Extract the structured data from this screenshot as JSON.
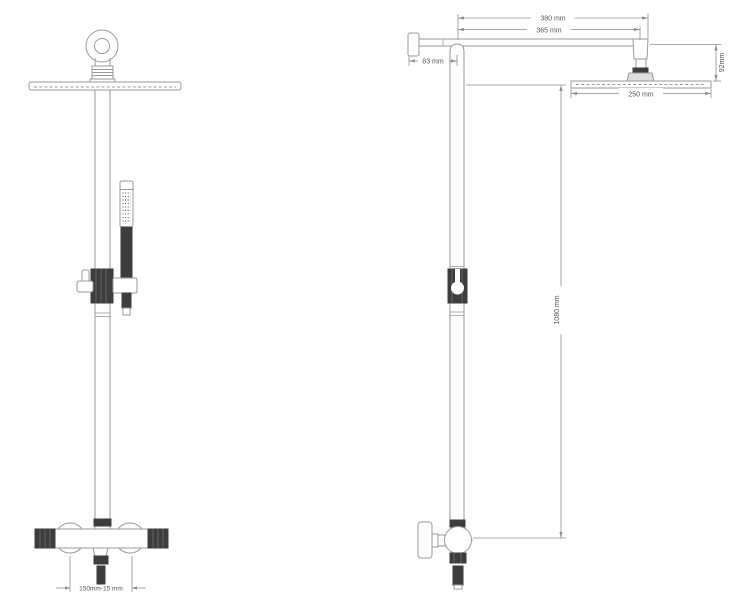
{
  "diagram": {
    "type": "technical-drawing",
    "subject": "thermostatic shower column, front view and side view with dimensions",
    "colors": {
      "background": "#ffffff",
      "outline": "#9a9a9a",
      "dimension_line": "#8f8f8f",
      "text": "#555555",
      "dark_fill": "#3d3d3d"
    },
    "front_view": {
      "inlet_spacing": "150mm-15 mm"
    },
    "side_view": {
      "arm_length_total": "380 mm",
      "arm_length_to_head_center": "365 mm",
      "wall_offset": "83 mm",
      "head_height": "92mm",
      "head_diameter": "250 mm",
      "riser_height": "1080 mm"
    }
  }
}
